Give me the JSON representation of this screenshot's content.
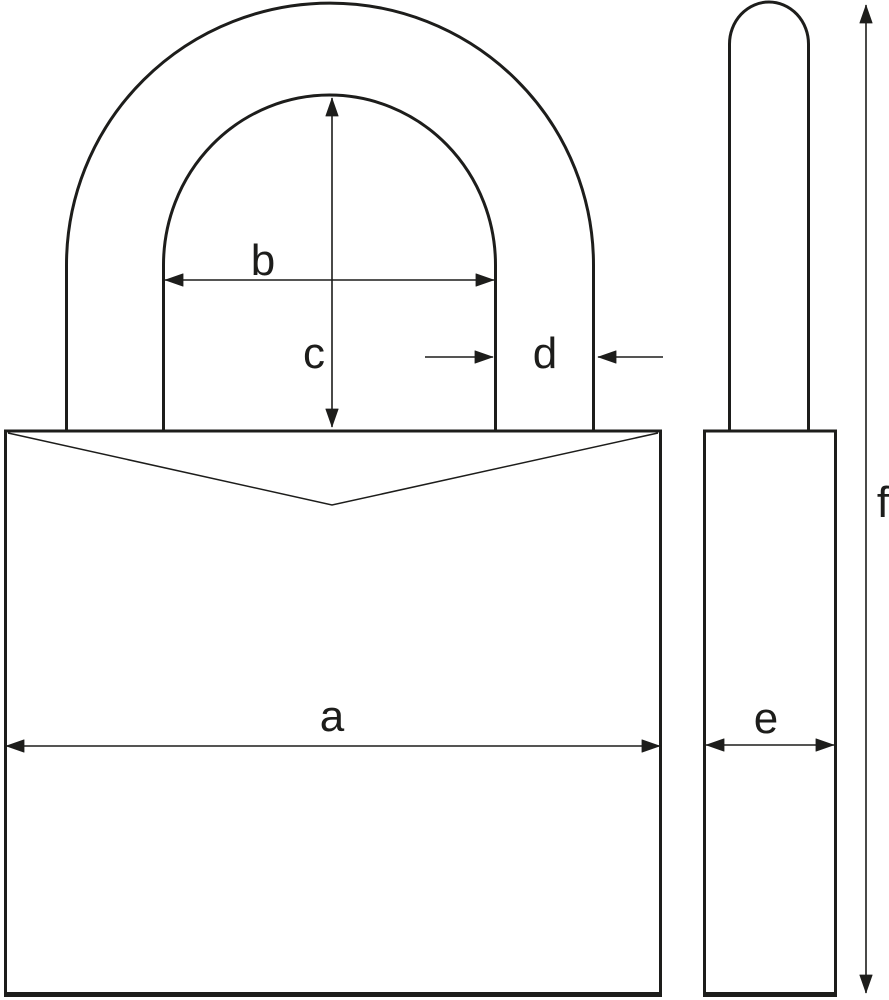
{
  "colors": {
    "line": "#1d1d1b",
    "background": "#ffffff"
  },
  "labels": {
    "a": "a",
    "b": "b",
    "c": "c",
    "d": "d",
    "e": "e",
    "f": "f"
  }
}
